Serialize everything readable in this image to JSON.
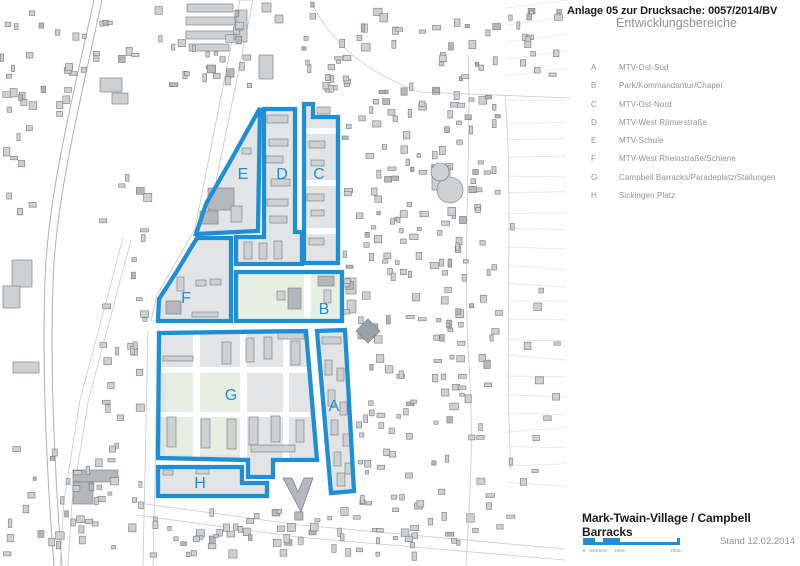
{
  "header": {
    "line1": "Anlage 05 zur Drucksache: 0057/2014/BV",
    "line2": "Entwicklungsbereiche"
  },
  "legend": {
    "items": [
      {
        "key": "A",
        "label": "MTV-Ost-Süd"
      },
      {
        "key": "B",
        "label": "Park/Kommandantur/Chapel"
      },
      {
        "key": "C",
        "label": "MTV-Ost-Nord"
      },
      {
        "key": "D",
        "label": "MTV-West Römerstraße"
      },
      {
        "key": "E",
        "label": "MTV-Schule"
      },
      {
        "key": "F",
        "label": "MTV-West Rheinstraße/Schiene"
      },
      {
        "key": "G",
        "label": "Campbell Barracks/Paradeplatz/Stallungen"
      },
      {
        "key": "H",
        "label": "Sickingen Platz"
      }
    ]
  },
  "footer": {
    "title": "Mark-Twain-Village / Campbell Barracks",
    "stand": "Stand 12.02.2014"
  },
  "scalebar": {
    "segments": [
      {
        "x": 0,
        "w": 12,
        "tall": true
      },
      {
        "x": 12,
        "w": 8,
        "tall": false
      },
      {
        "x": 20,
        "w": 17,
        "tall": true
      },
      {
        "x": 37,
        "w": 57,
        "tall": false
      },
      {
        "x": 94,
        "w": 3,
        "tall": true
      }
    ],
    "labels": [
      {
        "t": "0",
        "x": 1
      },
      {
        "t": "25m",
        "x": 11
      },
      {
        "t": "50m",
        "x": 20
      },
      {
        "t": "100m",
        "x": 37
      },
      {
        "t": "200m",
        "x": 93
      }
    ]
  },
  "colors": {
    "accent": "#1e8fd4",
    "zone_fill": "#e2e4e6",
    "park": "#e7efe3",
    "building": "#ced1d3",
    "building_dark": "#b4b8bc",
    "building_stroke": "#74787c",
    "line_light": "#c9c9c9",
    "line_rail": "#b0b0b0",
    "text_gray": "#8f9296",
    "text_black": "#1c1c1c"
  },
  "zones": [
    {
      "id": "A",
      "name": "MTV-Ost-Süd",
      "label_xy": [
        334,
        411
      ],
      "points": [
        [
          317,
          331
        ],
        [
          345,
          330
        ],
        [
          354,
          491
        ],
        [
          331,
          493
        ]
      ]
    },
    {
      "id": "B",
      "name": "Park/Kommandantur/Chapel",
      "label_xy": [
        324,
        314
      ],
      "points": [
        [
          236,
          272
        ],
        [
          342,
          272
        ],
        [
          342,
          321
        ],
        [
          236,
          321
        ]
      ],
      "park": true
    },
    {
      "id": "C",
      "name": "MTV-Ost-Nord",
      "label_xy": [
        319,
        179
      ],
      "points": [
        [
          304,
          104
        ],
        [
          313,
          104
        ],
        [
          313,
          117
        ],
        [
          338,
          117
        ],
        [
          338,
          263
        ],
        [
          304,
          263
        ]
      ]
    },
    {
      "id": "D",
      "name": "MTV-West Römerstraße",
      "label_xy": [
        282,
        179
      ],
      "points": [
        [
          264,
          109
        ],
        [
          295,
          109
        ],
        [
          295,
          232
        ],
        [
          302,
          232
        ],
        [
          302,
          264
        ],
        [
          236,
          264
        ],
        [
          236,
          237
        ],
        [
          264,
          237
        ]
      ]
    },
    {
      "id": "E",
      "name": "MTV-Schule",
      "label_xy": [
        243,
        179
      ],
      "points": [
        [
          260,
          108
        ],
        [
          258,
          231
        ],
        [
          196,
          234
        ],
        [
          206,
          204
        ],
        [
          231,
          160
        ]
      ]
    },
    {
      "id": "F",
      "name": "MTV-West Rheinstraße/Schiene",
      "label_xy": [
        186,
        303
      ],
      "points": [
        [
          197,
          238
        ],
        [
          231,
          238
        ],
        [
          231,
          321
        ],
        [
          158,
          321
        ],
        [
          159,
          299
        ],
        [
          177,
          271
        ]
      ]
    },
    {
      "id": "G",
      "name": "Campbell Barracks/Paradeplatz/Stallungen",
      "label_xy": [
        231,
        400
      ],
      "points": [
        [
          159,
          333
        ],
        [
          306,
          331
        ],
        [
          317,
          460
        ],
        [
          273,
          460
        ],
        [
          273,
          477
        ],
        [
          248,
          477
        ],
        [
          248,
          460
        ],
        [
          158,
          458
        ]
      ]
    },
    {
      "id": "H",
      "name": "Sickingen Platz",
      "label_xy": [
        200,
        488
      ],
      "points": [
        [
          158,
          467
        ],
        [
          242,
          467
        ],
        [
          242,
          483
        ],
        [
          267,
          483
        ],
        [
          267,
          496
        ],
        [
          158,
          496
        ]
      ]
    }
  ],
  "map": {
    "railway": [
      "M94,0 C72,100 52,180 46,260 C42,330 44,440 54,566",
      "M102,0 C80,102 60,182 54,262 C50,332 52,440 62,566"
    ],
    "road_lines": [
      "M123,238 L80,400 L64,500 L60,566",
      "M131,240 L88,402 L72,502 L68,566",
      "M138,503 L300,525 L565,549",
      "M136,515 L298,537 L565,560",
      "M148,330 L143,566",
      "M158,330 L153,566",
      "M468,55 C472,150 461,260 470,380 C474,460 468,520 466,566",
      "M505,95 C514,200 504,350 511,470",
      "M310,0 C330,40 360,70 420,92 L570,98"
    ],
    "diagonal_road": [
      [
        240,
        0
      ],
      [
        253,
        0
      ],
      [
        206,
        231
      ],
      [
        166,
        300
      ],
      [
        163,
        321
      ],
      [
        151,
        321
      ],
      [
        157,
        295
      ],
      [
        195,
        229
      ]
    ],
    "greens": [
      [
        238,
        274,
        103,
        46
      ],
      [
        166,
        374,
        74,
        81
      ]
    ],
    "streets_white": [
      [
        304,
        274,
        7,
        46
      ],
      [
        193,
        333,
        7,
        127
      ],
      [
        240,
        333,
        7,
        127
      ],
      [
        283,
        332,
        6,
        128
      ],
      [
        159,
        367,
        151,
        6
      ],
      [
        159,
        412,
        151,
        5
      ],
      [
        304,
        128,
        34,
        6
      ],
      [
        304,
        180,
        34,
        6
      ],
      [
        304,
        228,
        34,
        6
      ]
    ],
    "buildings": [
      [
        100,
        78,
        22,
        14,
        0
      ],
      [
        112,
        93,
        16,
        11,
        0
      ],
      [
        12,
        260,
        20,
        27,
        0
      ],
      [
        3,
        286,
        17,
        22,
        0
      ],
      [
        13,
        362,
        26,
        11,
        0
      ],
      [
        187,
        4,
        46,
        8,
        0
      ],
      [
        186,
        17,
        49,
        8,
        0
      ],
      [
        186,
        31,
        51,
        8,
        0
      ],
      [
        189,
        44,
        40,
        7,
        0
      ],
      [
        236,
        10,
        11,
        32,
        0
      ],
      [
        262,
        3,
        9,
        9,
        0
      ],
      [
        275,
        15,
        8,
        8,
        0
      ],
      [
        259,
        55,
        14,
        24,
        0
      ],
      [
        208,
        188,
        26,
        22,
        1
      ],
      [
        200,
        211,
        18,
        13,
        1
      ],
      [
        231,
        206,
        11,
        16,
        0
      ],
      [
        242,
        148,
        9,
        6,
        0
      ],
      [
        267,
        115,
        21,
        8,
        0
      ],
      [
        269,
        139,
        19,
        7,
        0
      ],
      [
        266,
        156,
        17,
        7,
        0
      ],
      [
        271,
        179,
        19,
        7,
        0
      ],
      [
        267,
        199,
        21,
        7,
        0
      ],
      [
        270,
        216,
        17,
        7,
        0
      ],
      [
        244,
        242,
        8,
        17,
        0
      ],
      [
        259,
        243,
        8,
        16,
        0
      ],
      [
        274,
        241,
        8,
        18,
        0
      ],
      [
        317,
        107,
        13,
        7,
        0
      ],
      [
        309,
        141,
        16,
        7,
        0
      ],
      [
        311,
        160,
        13,
        6,
        0
      ],
      [
        307,
        194,
        17,
        7,
        0
      ],
      [
        311,
        210,
        13,
        6,
        0
      ],
      [
        309,
        238,
        15,
        7,
        0
      ],
      [
        318,
        276,
        16,
        10,
        1
      ],
      [
        288,
        288,
        13,
        21,
        1
      ],
      [
        324,
        290,
        7,
        13,
        0
      ],
      [
        277,
        291,
        8,
        9,
        0
      ],
      [
        166,
        301,
        15,
        13,
        1
      ],
      [
        177,
        277,
        7,
        14,
        0
      ],
      [
        196,
        280,
        10,
        6,
        0
      ],
      [
        210,
        279,
        11,
        6,
        0
      ],
      [
        192,
        312,
        26,
        5,
        0
      ],
      [
        222,
        342,
        9,
        22,
        0
      ],
      [
        246,
        338,
        8,
        24,
        0
      ],
      [
        264,
        337,
        8,
        22,
        0
      ],
      [
        291,
        341,
        9,
        24,
        0
      ],
      [
        278,
        333,
        26,
        6,
        0
      ],
      [
        163,
        356,
        30,
        5,
        0
      ],
      [
        167,
        417,
        9,
        30,
        0
      ],
      [
        201,
        419,
        9,
        29,
        0
      ],
      [
        227,
        419,
        9,
        30,
        0
      ],
      [
        249,
        417,
        9,
        28,
        0
      ],
      [
        271,
        416,
        9,
        26,
        0
      ],
      [
        251,
        445,
        44,
        7,
        0
      ],
      [
        296,
        420,
        8,
        22,
        0
      ],
      [
        322,
        337,
        19,
        7,
        0
      ],
      [
        325,
        360,
        7,
        15,
        0
      ],
      [
        337,
        368,
        7,
        13,
        0
      ],
      [
        328,
        390,
        7,
        16,
        0
      ],
      [
        340,
        402,
        7,
        13,
        0
      ],
      [
        331,
        420,
        7,
        15,
        0
      ],
      [
        343,
        434,
        7,
        12,
        0
      ],
      [
        334,
        452,
        7,
        14,
        0
      ],
      [
        345,
        463,
        7,
        11,
        0
      ],
      [
        337,
        473,
        8,
        13,
        0
      ],
      [
        163,
        470,
        10,
        5,
        0
      ],
      [
        196,
        469,
        13,
        5,
        0
      ],
      [
        346,
        278,
        10,
        16,
        0
      ],
      [
        347,
        300,
        9,
        13,
        0
      ],
      [
        73,
        470,
        45,
        12,
        1
      ],
      [
        73,
        482,
        20,
        22,
        1
      ]
    ],
    "scatter": [
      [
        2,
        80,
        40,
        160,
        14,
        11
      ],
      [
        0,
        10,
        140,
        110,
        30,
        22
      ],
      [
        150,
        5,
        110,
        90,
        26,
        33
      ],
      [
        300,
        2,
        56,
        98,
        18,
        40
      ],
      [
        356,
        2,
        72,
        515,
        105,
        44
      ],
      [
        430,
        5,
        74,
        250,
        55,
        55
      ],
      [
        430,
        258,
        74,
        258,
        52,
        66
      ],
      [
        506,
        5,
        60,
        85,
        16,
        77
      ],
      [
        150,
        506,
        368,
        55,
        68,
        88
      ],
      [
        2,
        442,
        146,
        118,
        40,
        99
      ],
      [
        98,
        150,
        54,
        278,
        26,
        110
      ],
      [
        342,
        62,
        13,
        266,
        12,
        121
      ],
      [
        506,
        200,
        60,
        316,
        12,
        132
      ]
    ],
    "church": [
      [
        283,
        478
      ],
      [
        292,
        478
      ],
      [
        298,
        492
      ],
      [
        304,
        478
      ],
      [
        313,
        478
      ],
      [
        301,
        512
      ]
    ],
    "diamond": {
      "cx": 368,
      "cy": 331,
      "s": 17
    },
    "blob": {
      "rects": [
        [
          432,
          166,
          18,
          24
        ]
      ],
      "circles": [
        [
          450,
          190,
          13
        ],
        [
          440,
          172,
          9
        ]
      ]
    },
    "parcel_area": {
      "x": 506,
      "y": 100,
      "w": 60,
      "h": 400,
      "rows": 22,
      "seed": 7
    }
  }
}
